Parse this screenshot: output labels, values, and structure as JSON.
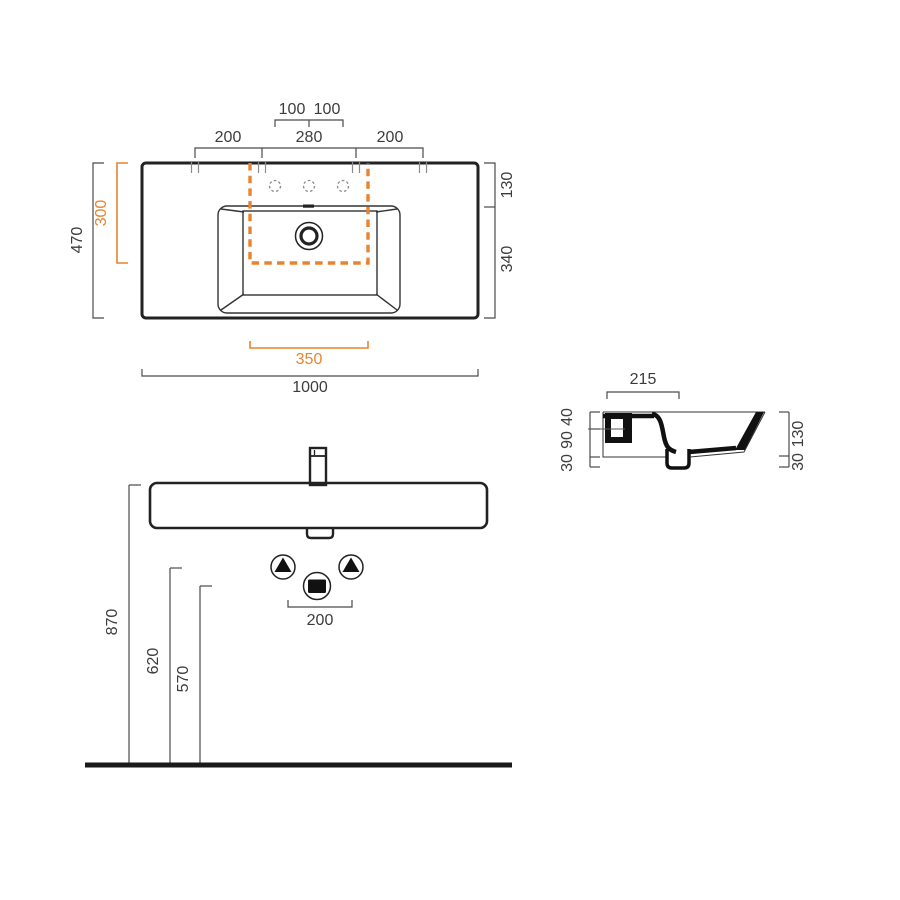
{
  "drawing": {
    "type": "washbasin-technical-drawing",
    "accent_color": "#E8842F",
    "line_color": "#222222"
  },
  "plan": {
    "hole_pitch_left": "100",
    "hole_pitch_right": "100",
    "fix_span_left": "200",
    "fix_span_center": "280",
    "fix_span_right": "200",
    "edge_to_holes": "130",
    "holes_to_front": "340",
    "total_depth": "470",
    "cutout_depth": "300",
    "cutout_width": "350",
    "total_width": "1000"
  },
  "section": {
    "ledge_depth": "215",
    "rim_drop": "40",
    "body_mid": "90",
    "boss_height": "30",
    "front_height": "130",
    "front_boss": "30"
  },
  "front": {
    "rim_height": "870",
    "supply_height": "620",
    "waste_height": "570",
    "supply_spacing": "200"
  }
}
